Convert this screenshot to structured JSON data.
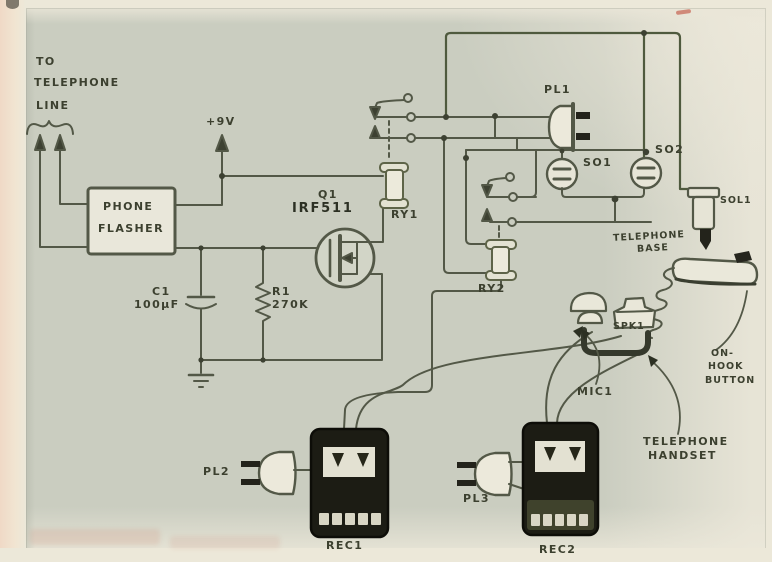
{
  "figure": {
    "kind": "hand-drawn electronic schematic",
    "subject": "telephone-activated tape recorder control circuit"
  },
  "colors": {
    "paper": "#ece8d9",
    "panel": "#cacdc0",
    "ink": "#535847",
    "ink_dark": "#2c3023",
    "device_black": "#1c1c14",
    "red_mark": "#bb3e2c"
  },
  "labels": {
    "to": "TO",
    "telephone": "TELEPHONE",
    "line": "LINE",
    "supply": "+9V",
    "phone": "PHONE",
    "flasher": "FLASHER",
    "q1": "Q1",
    "q1_part": "IRF511",
    "c1": "C1",
    "c1_value": "100µF",
    "r1": "R1",
    "r1_value": "270K",
    "ry1": "RY1",
    "ry2": "RY2",
    "pl1": "PL1",
    "pl2": "PL2",
    "pl3": "PL3",
    "so1": "SO1",
    "so2": "SO2",
    "sol1": "SOL1",
    "tel_base_line1": "TELEPHONE",
    "tel_base_line2": "BASE",
    "mic1": "MIC1",
    "spk1": "SPK1",
    "on_hook_line1": "ON-",
    "on_hook_line2": "HOOK",
    "on_hook_line3": "BUTTON",
    "handset_line1": "TELEPHONE",
    "handset_line2": "HANDSET",
    "rec1": "REC1",
    "rec2": "REC2"
  }
}
